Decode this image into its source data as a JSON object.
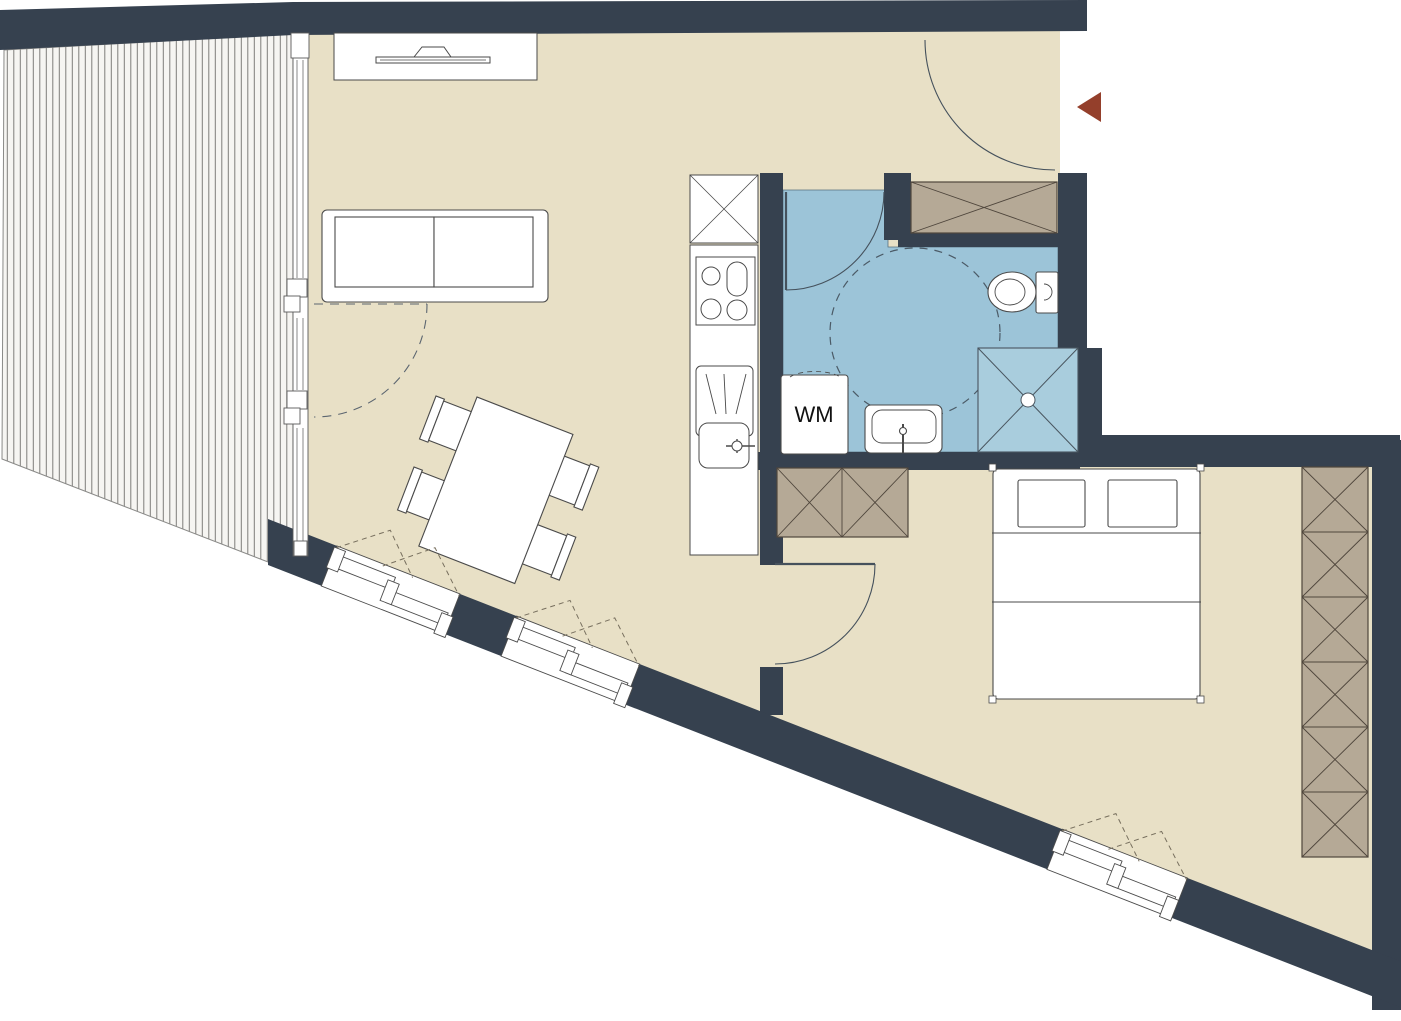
{
  "labels": {
    "washing_machine": "WM"
  },
  "colors": {
    "wall": "#36414f",
    "floor": "#e8e0c6",
    "bathroom_floor": "#9cc4d8",
    "shower": "#a9cddd",
    "wardrobe": "#b5a996",
    "terrace_deck": "#f6f5f2",
    "deck_line": "#7e7d7a",
    "furniture_fill": "#ffffff",
    "outline": "#4a4a4a",
    "door_arc": "#45515c",
    "entrance_arrow": "#943f2b"
  }
}
